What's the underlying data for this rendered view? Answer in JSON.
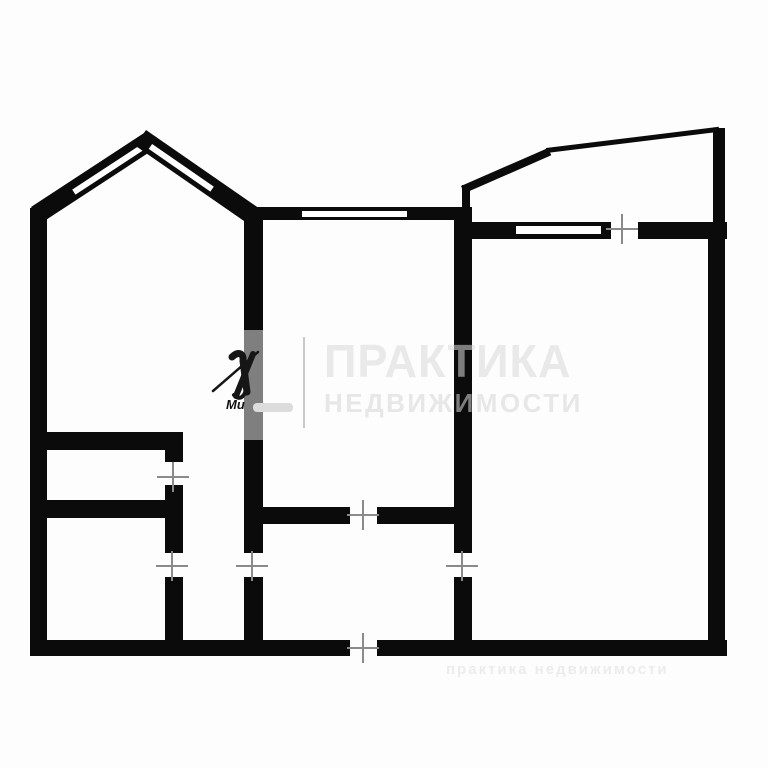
{
  "palette": {
    "wall": "#0b0b0b",
    "wall_faded": "#7f7f7f",
    "door_mark": "#8a8a8a",
    "background": "#fdfdfd",
    "wm_light": "#e9e9e9",
    "wm_light2": "#e7e7e7",
    "wm_on_wall": "#7d7d7d",
    "wm_separator": "#c9c9c9",
    "wm_footer": "#ececec",
    "logo_ink": "#161616"
  },
  "watermark": {
    "brand": "ПРАКТИКА",
    "tagline": "НЕДВИЖИМОСТИ",
    "logo_caption": "Ми",
    "footer_text": "практика недвижимости"
  },
  "floorplan": {
    "walls": [
      {
        "name": "wall-outer-left",
        "x": 30,
        "y": 208,
        "w": 17,
        "h": 448
      },
      {
        "name": "wall-outer-bottom-left",
        "x": 30,
        "y": 640,
        "w": 320,
        "h": 16
      },
      {
        "name": "wall-outer-bottom-right",
        "x": 377,
        "y": 640,
        "w": 350,
        "h": 16
      },
      {
        "name": "wall-outer-right",
        "x": 708,
        "y": 222,
        "w": 17,
        "h": 434
      },
      {
        "name": "wall-top-living",
        "x": 248,
        "y": 207,
        "w": 224,
        "h": 13
      },
      {
        "name": "wall-top-bedroom",
        "x": 455,
        "y": 222,
        "w": 272,
        "h": 17
      },
      {
        "name": "wall-mid-left-upper",
        "x": 244,
        "y": 207,
        "w": 19,
        "h": 346
      },
      {
        "name": "wall-mid-left-lower",
        "x": 244,
        "y": 577,
        "w": 19,
        "h": 63
      },
      {
        "name": "wall-mid-right-upper",
        "x": 454,
        "y": 208,
        "w": 18,
        "h": 345
      },
      {
        "name": "wall-mid-right-lower",
        "x": 454,
        "y": 577,
        "w": 18,
        "h": 63
      },
      {
        "name": "wall-closet-top",
        "x": 40,
        "y": 432,
        "w": 143,
        "h": 18
      },
      {
        "name": "wall-bath-top",
        "x": 40,
        "y": 500,
        "w": 125,
        "h": 18
      },
      {
        "name": "wall-inner-left-stub",
        "x": 165,
        "y": 450,
        "w": 18,
        "h": 12
      },
      {
        "name": "wall-inner-left-mid",
        "x": 165,
        "y": 485,
        "w": 18,
        "h": 68
      },
      {
        "name": "wall-inner-left-lower",
        "x": 165,
        "y": 577,
        "w": 18,
        "h": 63
      },
      {
        "name": "wall-hall-left",
        "x": 260,
        "y": 507,
        "w": 90,
        "h": 17
      },
      {
        "name": "wall-hall-right",
        "x": 377,
        "y": 507,
        "w": 77,
        "h": 17
      },
      {
        "name": "balcony-left-edge",
        "x": 462,
        "y": 185,
        "w": 8,
        "h": 27
      },
      {
        "name": "balcony-right-edge",
        "x": 713,
        "y": 128,
        "w": 12,
        "h": 97
      },
      {
        "name": "wall-faded-segment",
        "x": 244,
        "y": 330,
        "w": 19,
        "h": 110,
        "color": "#7f7f7f"
      }
    ],
    "windows": [
      {
        "name": "window-slot-living",
        "x": 302,
        "y": 211,
        "w": 105,
        "h": 6
      },
      {
        "name": "window-slot-bedroom",
        "x": 516,
        "y": 226,
        "w": 85,
        "h": 8
      }
    ],
    "gaps": [
      {
        "name": "wall-gap-balcony-door",
        "x": 611,
        "y": 222,
        "w": 27,
        "h": 17
      }
    ],
    "bars": [
      {
        "name": "slope-left",
        "x": 31,
        "y": 207,
        "len": 139,
        "ang": -33.2,
        "th": 19,
        "win": {
          "outer": 8,
          "glass": 6,
          "start": 44,
          "end": 127
        }
      },
      {
        "name": "slope-right",
        "x": 146,
        "y": 130,
        "len": 142,
        "ang": 34.7,
        "th": 19,
        "win": {
          "outer": 8,
          "glass": 6,
          "start": 13,
          "end": 88
        }
      },
      {
        "name": "balcony-angled-thick",
        "x": 461,
        "y": 186,
        "len": 95,
        "ang": -23.6,
        "th": 8
      },
      {
        "name": "balcony-angled-thin",
        "x": 546,
        "y": 148,
        "len": 174,
        "ang": -7.0,
        "th": 5
      }
    ],
    "door_marks": [
      {
        "name": "door-mark-closet",
        "x": 173,
        "y": 477,
        "o": "v"
      },
      {
        "name": "door-mark-bath",
        "x": 172,
        "y": 566,
        "o": "v"
      },
      {
        "name": "door-mark-hall-left",
        "x": 252,
        "y": 566,
        "o": "v"
      },
      {
        "name": "door-mark-bedroom",
        "x": 462,
        "y": 566,
        "o": "v"
      },
      {
        "name": "door-mark-living",
        "x": 363,
        "y": 515,
        "o": "h"
      },
      {
        "name": "door-mark-entrance",
        "x": 363,
        "y": 648,
        "o": "h"
      },
      {
        "name": "door-mark-balcony",
        "x": 622,
        "y": 229,
        "o": "h"
      }
    ]
  }
}
